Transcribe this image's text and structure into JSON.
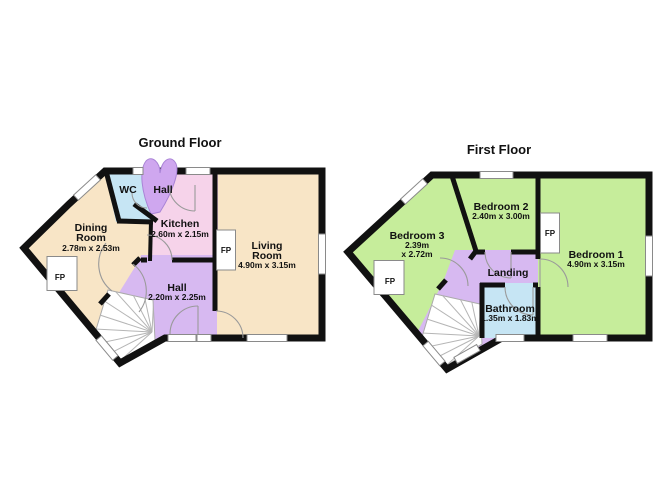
{
  "ground": {
    "title": "Ground Floor",
    "wc": {
      "name": "WC"
    },
    "hall_top": {
      "name": "Hall"
    },
    "kitchen": {
      "name": "Kitchen",
      "dims": "2.60m x 2.15m"
    },
    "dining": {
      "line1": "Dining",
      "line2": "Room",
      "dims": "2.78m x 2.53m",
      "fp": "FP"
    },
    "living": {
      "line1": "Living",
      "line2": "Room",
      "dims": "4.90m x 3.15m",
      "fp": "FP"
    },
    "hall": {
      "name": "Hall",
      "dims": "2.20m x 2.25m"
    }
  },
  "first": {
    "title": "First Floor",
    "bedroom2": {
      "name": "Bedroom 2",
      "dims": "2.40m x 3.00m"
    },
    "bedroom3": {
      "name": "Bedroom 3",
      "dims1": "2.39m",
      "dims2": "x 2.72m",
      "fp": "FP"
    },
    "bedroom1": {
      "name": "Bedroom 1",
      "dims": "4.90m x 3.15m",
      "fp": "FP"
    },
    "landing": {
      "name": "Landing"
    },
    "bathroom": {
      "name": "Bathroom",
      "dims": "1.35m x 1.83m"
    }
  },
  "colors": {
    "room_cream": "#F8E5C6",
    "room_pink": "#F6D3EA",
    "room_purple": "#D7B9F1",
    "petal_purple": "#CFA7EF",
    "room_blue": "#C6E5F4",
    "room_green": "#C6ED9B",
    "wall": "#111111"
  }
}
